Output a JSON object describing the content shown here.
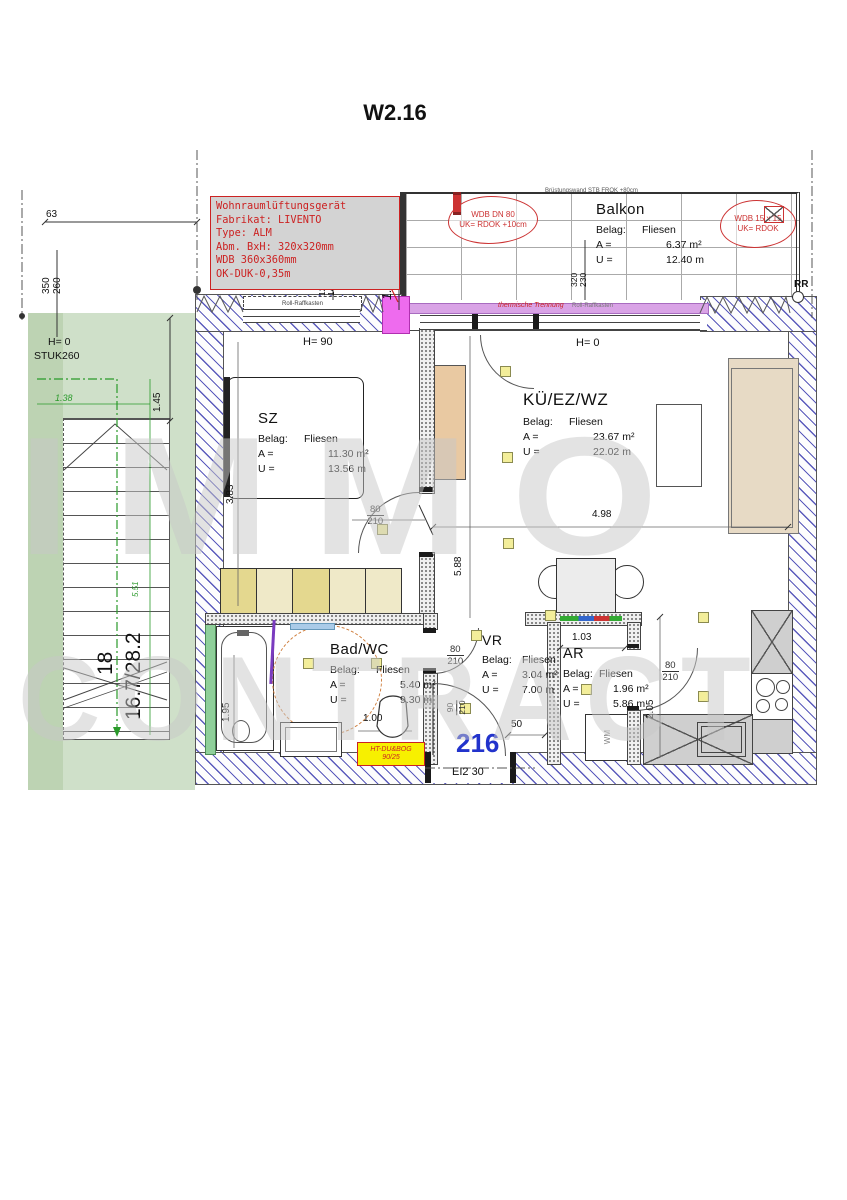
{
  "title": "W2.16",
  "watermark": {
    "line1": "IMMO",
    "line2": "CONTRACT"
  },
  "vent_box": {
    "line1": "Wohnraumlüftungsgerät",
    "line2": "Fabrikat: LIVENTO",
    "line3": "Type: ALM",
    "line4": "Abm. BxH: 320x320mm",
    "line5": "WDB  360x360mm",
    "line6": "OK-DUK-0,35m"
  },
  "balcony": {
    "name": "Balkon",
    "belag_label": "Belag:",
    "belag": "Fliesen",
    "a_label": "A =",
    "a_value": "6.37 m²",
    "u_label": "U =",
    "u_value": "12.40 m",
    "parapet_note": "Brüstungswand STB FROK +80cm",
    "cloud_left_line1": "WDB DN 80",
    "cloud_left_line2": "UK= RDOK +10cm",
    "cloud_right_line1": "WDB 15 x 15",
    "cloud_right_line2": "UK= RDOK",
    "rr_label": "RR"
  },
  "rooms": {
    "sz": {
      "name": "SZ",
      "belag_label": "Belag:",
      "belag": "Fliesen",
      "a_label": "A =",
      "a_value": "11.30 m²",
      "u_label": "U =",
      "u_value": "13.56 m",
      "height_note": "H= 90"
    },
    "kue": {
      "name": "KÜ/EZ/WZ",
      "belag_label": "Belag:",
      "belag": "Fliesen",
      "a_label": "A =",
      "a_value": "23.67 m²",
      "u_label": "U =",
      "u_value": "22.02 m",
      "height_note": "H= 0"
    },
    "bad": {
      "name": "Bad/WC",
      "belag_label": "Belag:",
      "belag": "Fliesen",
      "a_label": "A =",
      "a_value": "5.40 m²",
      "u_label": "U =",
      "u_value": "9.30 m"
    },
    "vr": {
      "name": "VR",
      "belag_label": "Belag:",
      "belag": "Fliesen",
      "a_label": "A =",
      "a_value": "3.04 m²",
      "u_label": "U =",
      "u_value": "7.00 m"
    },
    "ar": {
      "name": "AR",
      "belag_label": "Belag:",
      "belag": "Fliesen",
      "a_label": "A =",
      "a_value": "1.96 m²",
      "u_label": "U =",
      "u_value": "5.86 m"
    }
  },
  "stair": {
    "height_note": "H= 0",
    "stuk_label": "STUK260",
    "risers": "18",
    "ratio": "16.7/28.2",
    "area_note": "5.51",
    "dim_green": "1.38",
    "dim_black": "1.45"
  },
  "dims": {
    "d63": "63",
    "d350": "350",
    "d260": "260",
    "d165": "1.65",
    "d120": "120",
    "d140": "140",
    "d320": "320",
    "d230": "230",
    "d383": "3.83",
    "d498": "4.98",
    "d588": "5.88",
    "d195": "1.95",
    "d100": "1.00",
    "d103": "1.03",
    "d205": "2.05",
    "d50": "50"
  },
  "doors": {
    "w80": "80",
    "w90": "90",
    "h210": "210",
    "entrance_rating": "EI2 30",
    "apartment_number": "216"
  },
  "notes": {
    "roll_kasten": "Roll-Raffkasten",
    "thermal": "thermische Trennung",
    "duct_line1": "HT-DU&BOG",
    "duct_line2": "90/25",
    "wm": "WM"
  },
  "colors": {
    "hatch_blue": "#3e3eb0",
    "green_area": "#cfe0c9",
    "magenta_unit": "#ee6bee",
    "purple_strip": "#d9a3e6",
    "red_annotation": "#cc2222",
    "yellow_marker": "#f3ee9a",
    "apartment_number_blue": "#2233cc",
    "duct_yellow": "#f7f000",
    "tan_furniture": "#e9c9a2",
    "beige_sofa": "#e7dac5",
    "wardrobe_yellow": "#e4d88f"
  }
}
